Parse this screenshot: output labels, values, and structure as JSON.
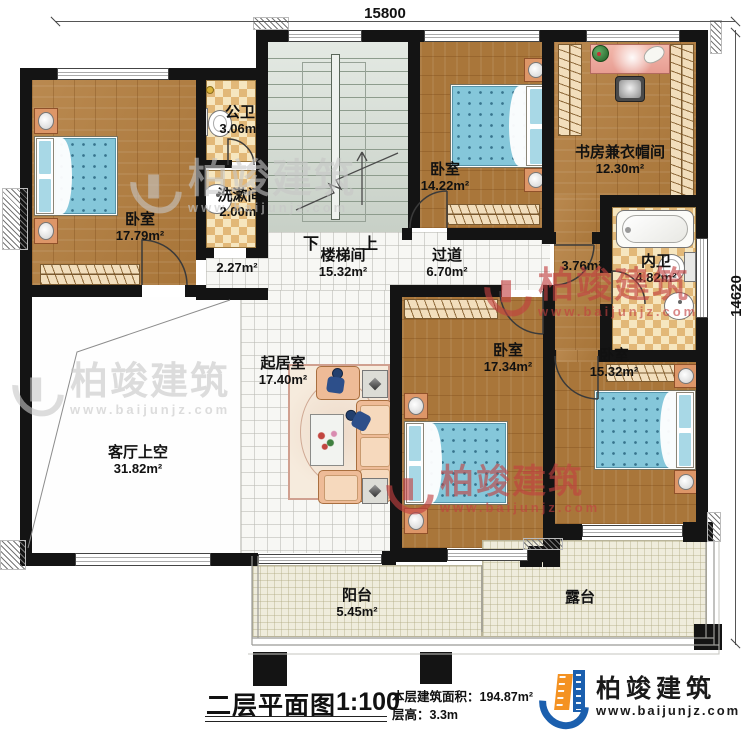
{
  "meta": {
    "title": "二层平面图",
    "scale": "1:100",
    "area_label": "本层建筑面积：",
    "area_value": "194.87m²",
    "height_label": "层高：",
    "height_value": "3.3m"
  },
  "branding": {
    "company": "柏竣建筑",
    "website": "www.baijunjz.com"
  },
  "dimensions": {
    "top": "15800",
    "right": "14620"
  },
  "stairs": {
    "down": "下",
    "up": "上"
  },
  "rooms": [
    {
      "id": "bedroom-top-left",
      "name": "卧室",
      "area": "17.79m²"
    },
    {
      "id": "public-bath",
      "name": "公卫",
      "area": "3.06m²"
    },
    {
      "id": "washroom",
      "name": "洗漱间",
      "area": "2.00m²"
    },
    {
      "id": "stairwell",
      "name": "楼梯间",
      "area": "15.32m²"
    },
    {
      "id": "hallway",
      "name": "过道",
      "area": "6.70m²"
    },
    {
      "id": "hall-nook-left",
      "name": "",
      "area": "2.27m²"
    },
    {
      "id": "hall-nook-right",
      "name": "",
      "area": "3.76m²"
    },
    {
      "id": "bedroom-top-middle",
      "name": "卧室",
      "area": "14.22m²"
    },
    {
      "id": "study-cloakroom",
      "name": "书房兼衣帽间",
      "area": "12.30m²"
    },
    {
      "id": "ensuite-bath",
      "name": "内卫",
      "area": "4.82m²"
    },
    {
      "id": "living-room",
      "name": "起居室",
      "area": "17.40m²"
    },
    {
      "id": "living-void",
      "name": "客厅上空",
      "area": "31.82m²"
    },
    {
      "id": "bedroom-bottom-middle",
      "name": "卧室",
      "area": "17.34m²"
    },
    {
      "id": "bedroom-bottom-right",
      "name": "卧室",
      "area": "15.32m²"
    },
    {
      "id": "balcony",
      "name": "阳台",
      "area": "5.45m²"
    },
    {
      "id": "terrace",
      "name": "露台",
      "area": ""
    }
  ],
  "colors": {
    "wall": "#141414",
    "wood_floor": "#b27c3c",
    "bath_tile": "#e9c489",
    "stair_floor": "#d2dbd1",
    "deck_floor": "#efecdc",
    "bed_blue": "#85c7da",
    "brand_blue": "#1b5fae",
    "brand_orange": "#f49222",
    "watermark_red": "#c24040",
    "watermark_gray": "#c7c7c7"
  }
}
